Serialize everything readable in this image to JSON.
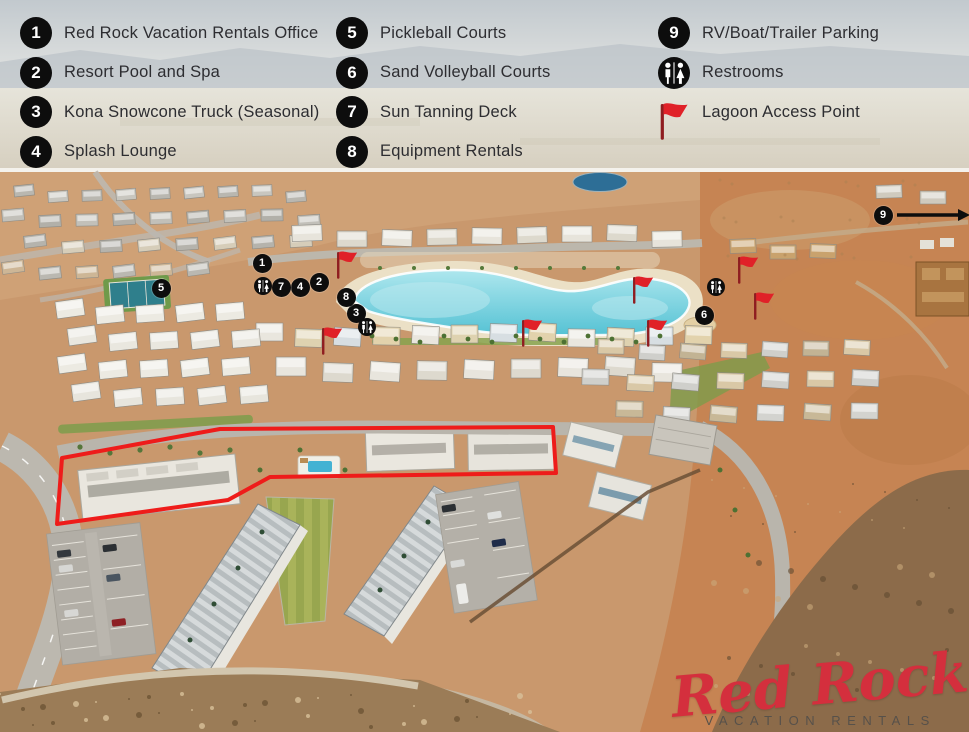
{
  "legend": {
    "columns": [
      {
        "items": [
          {
            "icon": "1",
            "label": "Red Rock Vacation Rentals Office"
          },
          {
            "icon": "2",
            "label": "Resort Pool and Spa"
          },
          {
            "icon": "3",
            "label": "Kona Snowcone Truck (Seasonal)"
          },
          {
            "icon": "4",
            "label": "Splash Lounge"
          }
        ]
      },
      {
        "items": [
          {
            "icon": "5",
            "label": "Pickleball Courts"
          },
          {
            "icon": "6",
            "label": "Sand Volleyball Courts"
          },
          {
            "icon": "7",
            "label": "Sun Tanning Deck"
          },
          {
            "icon": "8",
            "label": "Equipment Rentals"
          }
        ]
      },
      {
        "items": [
          {
            "icon": "9",
            "label": "RV/Boat/Trailer Parking"
          },
          {
            "icon": "restroom",
            "label": "Restrooms"
          },
          {
            "icon": "flag",
            "label": "Lagoon Access Point"
          }
        ]
      }
    ]
  },
  "map": {
    "number_markers": [
      {
        "n": "1",
        "x": 262,
        "y": 263
      },
      {
        "n": "2",
        "x": 319,
        "y": 282
      },
      {
        "n": "3",
        "x": 356,
        "y": 313
      },
      {
        "n": "4",
        "x": 300,
        "y": 287
      },
      {
        "n": "5",
        "x": 161,
        "y": 288
      },
      {
        "n": "6",
        "x": 704,
        "y": 315
      },
      {
        "n": "7",
        "x": 281,
        "y": 287
      },
      {
        "n": "8",
        "x": 346,
        "y": 297
      },
      {
        "n": "9",
        "x": 883,
        "y": 215
      }
    ],
    "restroom_markers": [
      {
        "x": 263,
        "y": 286
      },
      {
        "x": 367,
        "y": 327
      },
      {
        "x": 716,
        "y": 287
      }
    ],
    "flag_markers": [
      {
        "x": 339,
        "y": 276
      },
      {
        "x": 324,
        "y": 352
      },
      {
        "x": 524,
        "y": 344
      },
      {
        "x": 635,
        "y": 301
      },
      {
        "x": 740,
        "y": 281
      },
      {
        "x": 756,
        "y": 317
      },
      {
        "x": 649,
        "y": 344
      }
    ],
    "arrow": {
      "x1": 897,
      "y1": 215,
      "x2": 962,
      "y2": 214
    }
  },
  "logo": {
    "script": "Red Rock",
    "subtitle": "VACATION RENTALS"
  },
  "colors": {
    "marker_bg": "#0d0d0d",
    "marker_text": "#ffffff",
    "flag_red": "#e02128",
    "flag_pole": "#8f1d20",
    "outline_red": "#ee1c1a",
    "legend_text": "#2d2d31",
    "logo_script": "#d42f3d",
    "logo_sub": "#57514a",
    "lagoon": "#5fc6d6",
    "lawn": "#a6b056"
  }
}
